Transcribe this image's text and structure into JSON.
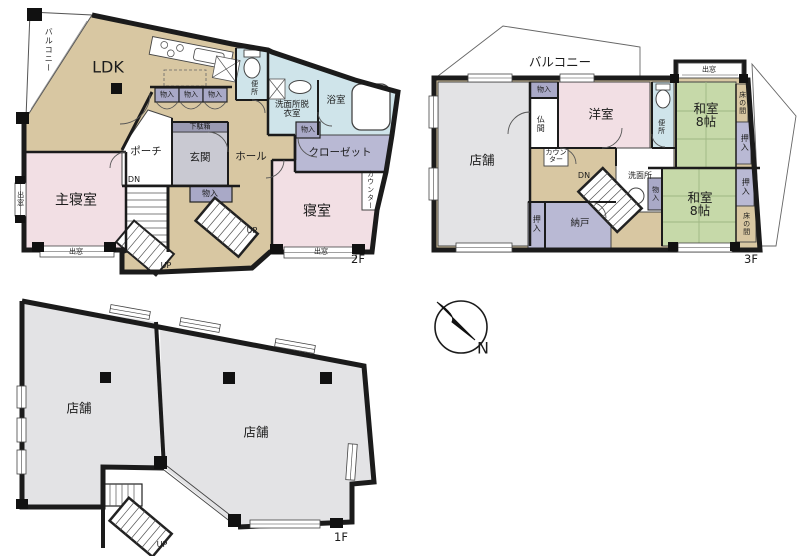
{
  "palette": {
    "wall": "#1b1b1b",
    "room_tan": "#d8c7a2",
    "room_pink": "#f2dfe4",
    "room_blue": "#cfe4ea",
    "room_purple": "#b9b9d4",
    "room_purple_dark": "#a9a9c7",
    "room_green": "#c6d9a9",
    "room_gray": "#e3e3e5",
    "entrance_gray": "#c9c9d2"
  },
  "f2": {
    "tag": "2F",
    "balcony": "バルコニー",
    "ldk": "LDK",
    "toilet": "便所",
    "washroom": "洗面所脱衣室",
    "bath": "浴室",
    "storage": "物入",
    "shoe_cabinet": "下駄箱",
    "hall": "ホール",
    "entrance": "玄関",
    "porch": "ポーチ",
    "closet": "クローゼット",
    "counter": "カウンター",
    "master_bedroom": "主寝室",
    "bedroom": "寝室",
    "bay_window": "出窓",
    "dn": "DN",
    "up": "UP"
  },
  "f3": {
    "tag": "3F",
    "balcony": "バルコニー",
    "shop": "店舗",
    "storage": "物入",
    "altar": "仏間",
    "western": "洋室",
    "toilet": "便所",
    "counter": "カウンター",
    "washroom": "洗面所",
    "dn": "DN",
    "jp_room": "和室",
    "jp_size": "8帖",
    "tokonoma": "床の間",
    "oshiire": "押入",
    "storeroom": "納戸",
    "bay_window": "出窓"
  },
  "f1": {
    "tag": "1F",
    "shop": "店舗",
    "up": "UP"
  },
  "compass": {
    "north": "N"
  }
}
